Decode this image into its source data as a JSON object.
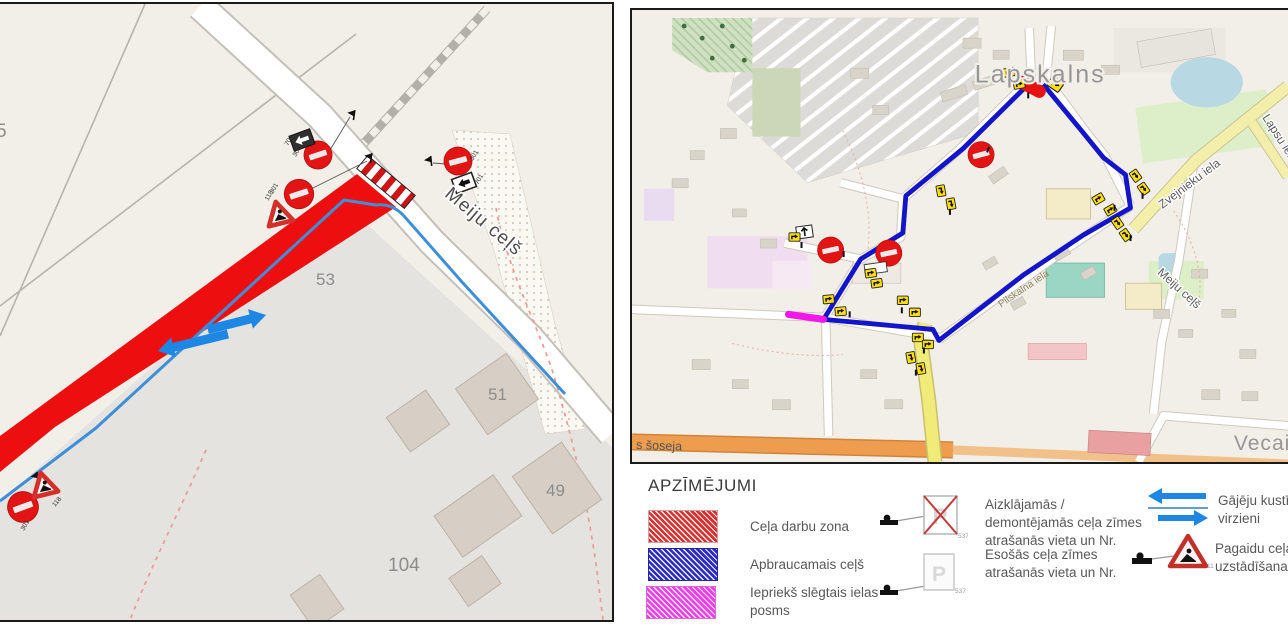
{
  "left_map": {
    "street": "Meiju ceļš",
    "numbers": {
      "n5": "5",
      "n53": "53",
      "n51": "51",
      "n49": "49",
      "n104": "104"
    },
    "sign_codes": {
      "no_entry": "301",
      "road_works": "118",
      "detour": "701"
    }
  },
  "right_map": {
    "places": {
      "lapskalns": "Lapskalns",
      "vecais": "Vecais"
    },
    "streets": {
      "zvejnieku": "Zvejnieku iela",
      "meiju": "Meiju ceļš",
      "soseja": "s šoseja",
      "lapsu": "Lapsu iela",
      "pilskalna": "Pilskalna iela"
    }
  },
  "legend": {
    "title": "APZĪMĒJUMI",
    "zones": [
      {
        "label": "Ceļa darbu zona"
      },
      {
        "label": "Apbraucamais ceļš"
      },
      {
        "label": "Iepriekš slēgtais ielas posms"
      }
    ],
    "signs": [
      {
        "number": "537",
        "label": "Aizklājamās / demontējamās ceļa zīmes atrašanās vieta un Nr."
      },
      {
        "number": "537",
        "label": "Esošās ceļa zīmes atrašanās vieta un Nr."
      }
    ],
    "arrows_label": "Gājēju kustības virzieni",
    "triangle": {
      "number": "118",
      "label": "Pagaidu ceļa zīmju uzstādīšanas vieta"
    }
  },
  "colors": {
    "work_zone": "#ed1010",
    "detour_route": "#1414c8",
    "closed_segment": "#f318e8",
    "pedestrian_arrow": "#1e87e5"
  }
}
